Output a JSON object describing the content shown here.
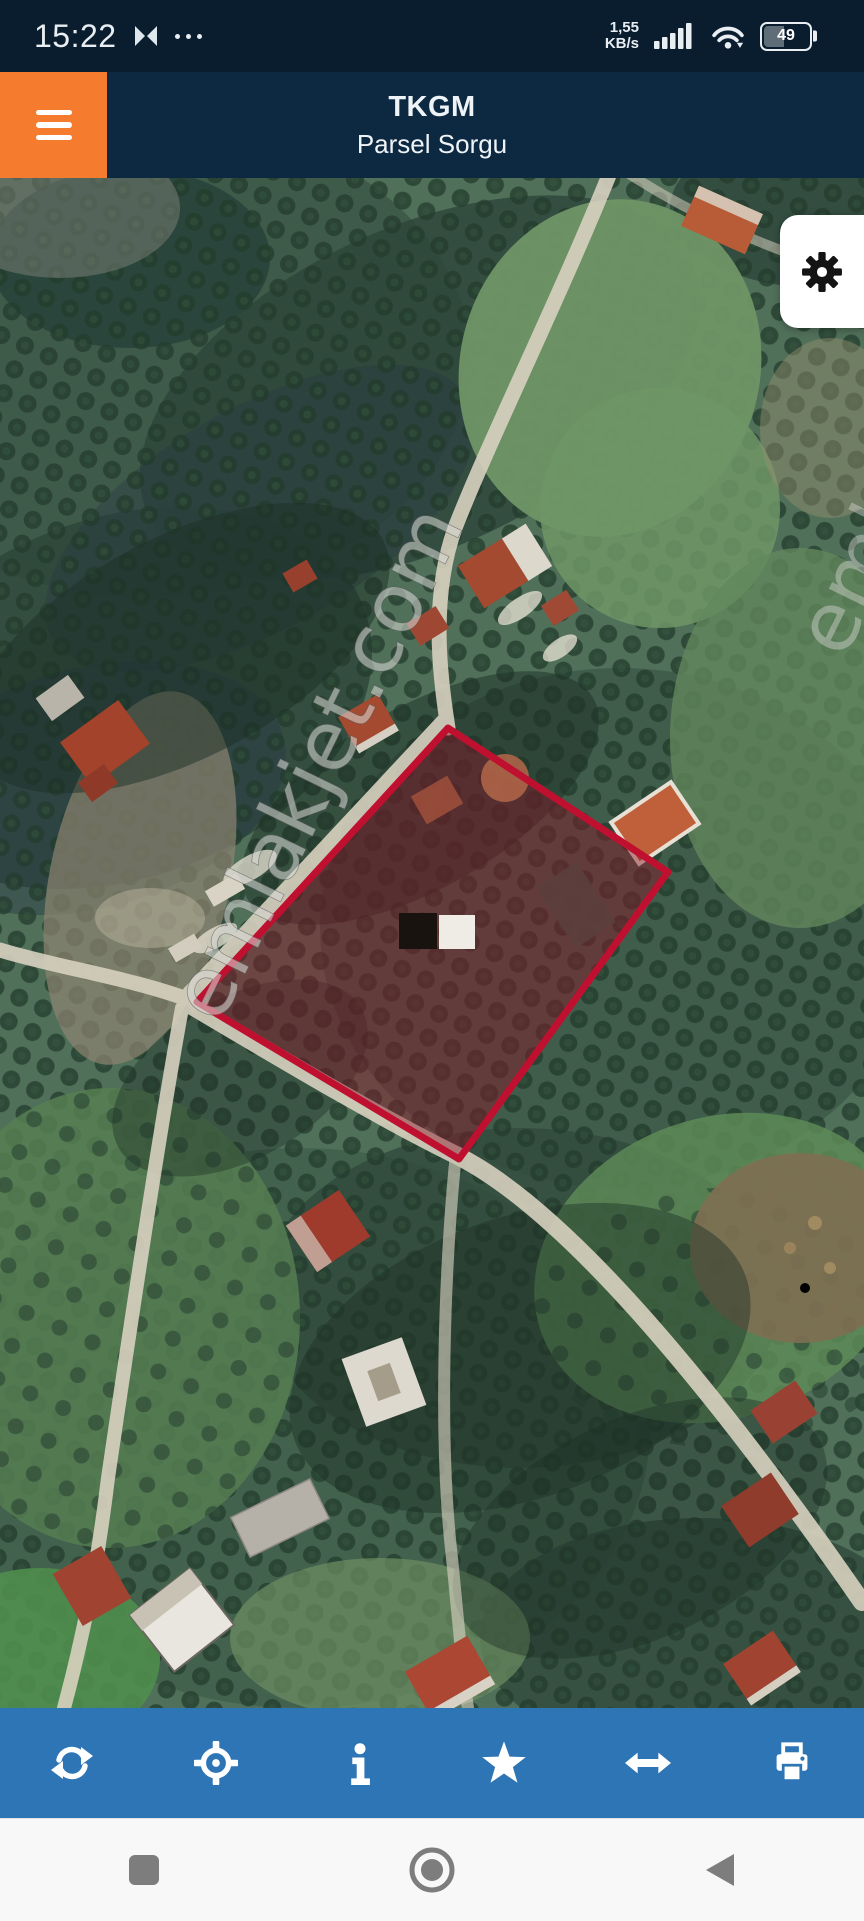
{
  "status_bar": {
    "time": "15:22",
    "hourglass_icon": "hourglass",
    "more_icon": "ellipsis",
    "net_speed_value": "1,55",
    "net_speed_unit": "KB/s",
    "signal_icon": "cellular-signal",
    "wifi_icon": "wifi-with-download-arrow",
    "battery_percent": "49"
  },
  "header": {
    "title": "TKGM",
    "subtitle": "Parsel Sorgu",
    "menu_icon": "hamburger-menu"
  },
  "map": {
    "type": "satellite-imagery",
    "watermark": "emlakjet.com",
    "parcel_outline_color": "#c01030",
    "parcel_fill_color": "rgba(139,20,40,0.45)",
    "settings_icon": "gear"
  },
  "toolbar": {
    "background_color": "#2e75b6",
    "icons": [
      "refresh",
      "locate",
      "info",
      "favorite",
      "swap-horizontal",
      "print"
    ]
  },
  "nav_bar": {
    "icons": [
      "recents",
      "home",
      "back"
    ]
  },
  "theme": {
    "status_bar_bg": "#0a1d2e",
    "header_bg": "#0d2941",
    "menu_button_bg": "#f57c2f",
    "toolbar_bg": "#2e75b6",
    "nav_bar_bg": "#f8f8f8"
  }
}
